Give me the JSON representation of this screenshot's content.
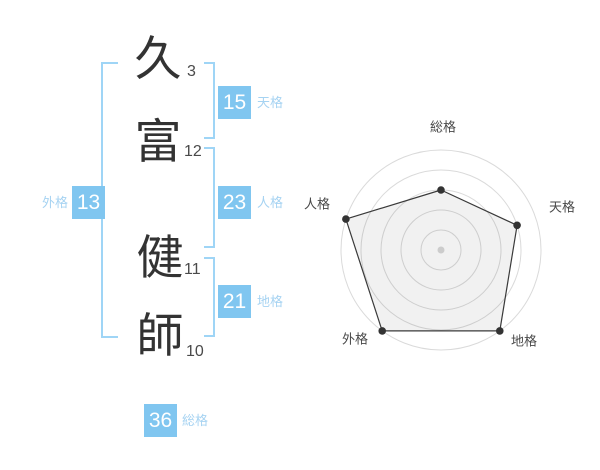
{
  "colors": {
    "page_bg": "#ffffff",
    "badge_blue": "#80c6f0",
    "label_blue": "#a6d3f2",
    "bracket_blue": "#9fd5f6",
    "text_dark": "#333333",
    "stroke_num": "#4a4a4a",
    "radar_label": "#484848"
  },
  "name_analysis": {
    "characters": [
      {
        "char": "久",
        "strokes": "3"
      },
      {
        "char": "富",
        "strokes": "12"
      },
      {
        "char": "健",
        "strokes": "11"
      },
      {
        "char": "師",
        "strokes": "10"
      }
    ],
    "kaku": {
      "tenkaku": {
        "value": "15",
        "label": "天格"
      },
      "jinkaku": {
        "value": "23",
        "label": "人格"
      },
      "chikaku": {
        "value": "21",
        "label": "地格"
      },
      "gaikaku": {
        "value": "13",
        "label": "外格"
      },
      "soukaku": {
        "value": "36",
        "label": "総格"
      }
    }
  },
  "chart_data": {
    "type": "radar",
    "title": "",
    "categories": [
      "総格",
      "天格",
      "地格",
      "外格",
      "人格"
    ],
    "values": [
      3,
      4,
      5,
      5,
      5
    ],
    "max": 5,
    "rings": 5,
    "start_angle_deg": -90,
    "clockwise": true,
    "legend": false,
    "ring_color": "#dadada",
    "series_color": "#3a3a3a",
    "fill_color": "#000000",
    "fill_opacity": 0.055,
    "vertex_dot_color": "#333333",
    "center_dot_color": "#cccccc",
    "layout": {
      "center": [
        151,
        145
      ],
      "radius": 100,
      "label_positions": [
        [
          153,
          22
        ],
        [
          272,
          102
        ],
        [
          234,
          236
        ],
        [
          65,
          234
        ],
        [
          27,
          99
        ]
      ],
      "label_font_size": 13
    }
  }
}
